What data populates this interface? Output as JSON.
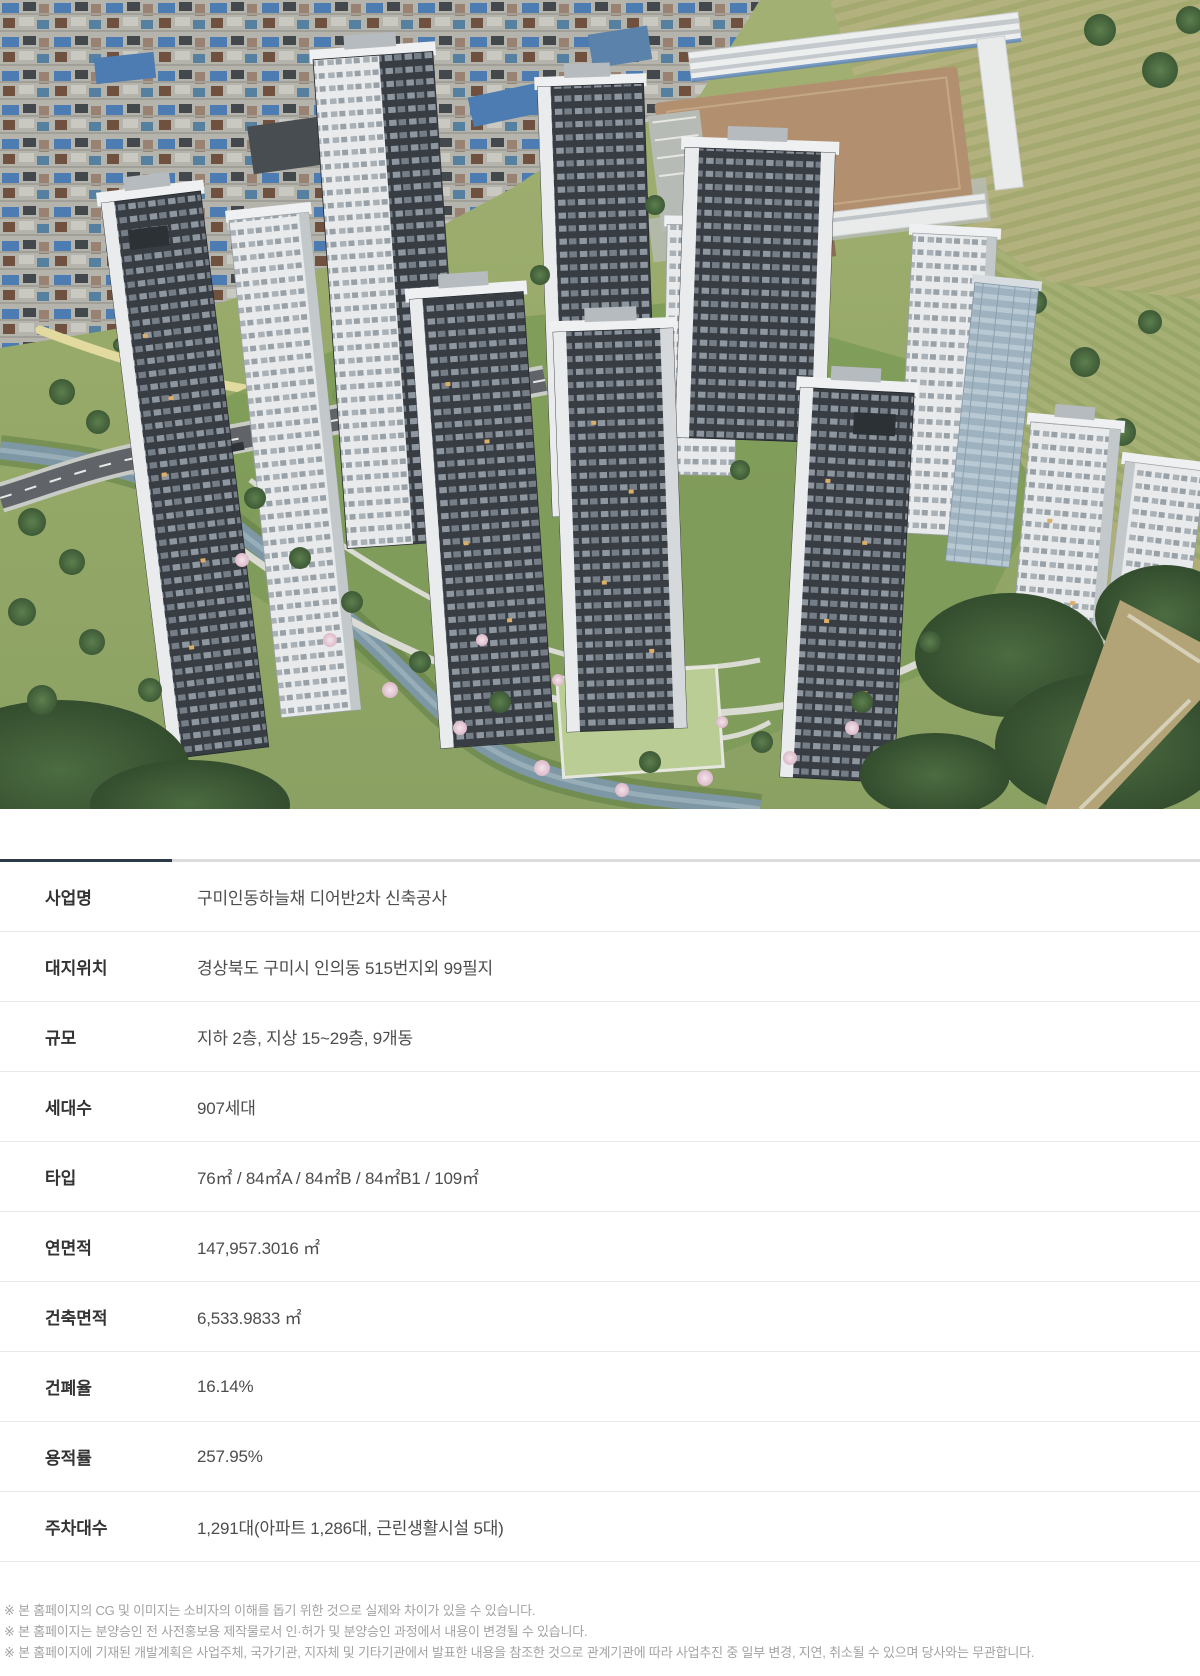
{
  "hero": {
    "description": "구미인동하늘채 디어반2차 아파트 단지 항공 조감도 (CG)"
  },
  "divider": {
    "accent_color": "#2d3a47",
    "line_color": "#dcdcdc"
  },
  "info_table": {
    "rows": [
      {
        "label": "사업명",
        "value": "구미인동하늘채 디어반2차 신축공사"
      },
      {
        "label": "대지위치",
        "value": "경상북도 구미시 인의동 515번지외 99필지"
      },
      {
        "label": "규모",
        "value": "지하 2층, 지상 15~29층, 9개동"
      },
      {
        "label": "세대수",
        "value": "907세대"
      },
      {
        "label": "타입",
        "value": "76㎡ / 84㎡A / 84㎡B / 84㎡B1 / 109㎡"
      },
      {
        "label": "연면적",
        "value": "147,957.3016 ㎡"
      },
      {
        "label": "건축면적",
        "value": "6,533.9833 ㎡"
      },
      {
        "label": "건폐율",
        "value": "16.14%"
      },
      {
        "label": "용적률",
        "value": "257.95%"
      },
      {
        "label": "주차대수",
        "value": "1,291대(아파트 1,286대, 근린생활시설 5대)"
      }
    ]
  },
  "footnotes": [
    "※ 본 홈페이지의 CG 및 이미지는 소비자의 이해를 돕기 위한 것으로 실제와 차이가 있을 수 있습니다.",
    "※ 본 홈페이지는 분양승인 전 사전홍보용 제작물로서 인·허가 및 분양승인 과정에서 내용이 변경될 수 있습니다.",
    "※ 본 홈페이지에 기재된 개발계획은 사업주체, 국가기관, 지자체 및 기타기관에서 발표한 내용을 참조한 것으로 관계기관에 따라 사업추진 중 일부 변경, 지연, 취소될 수 있으며 당사와는 무관합니다."
  ]
}
